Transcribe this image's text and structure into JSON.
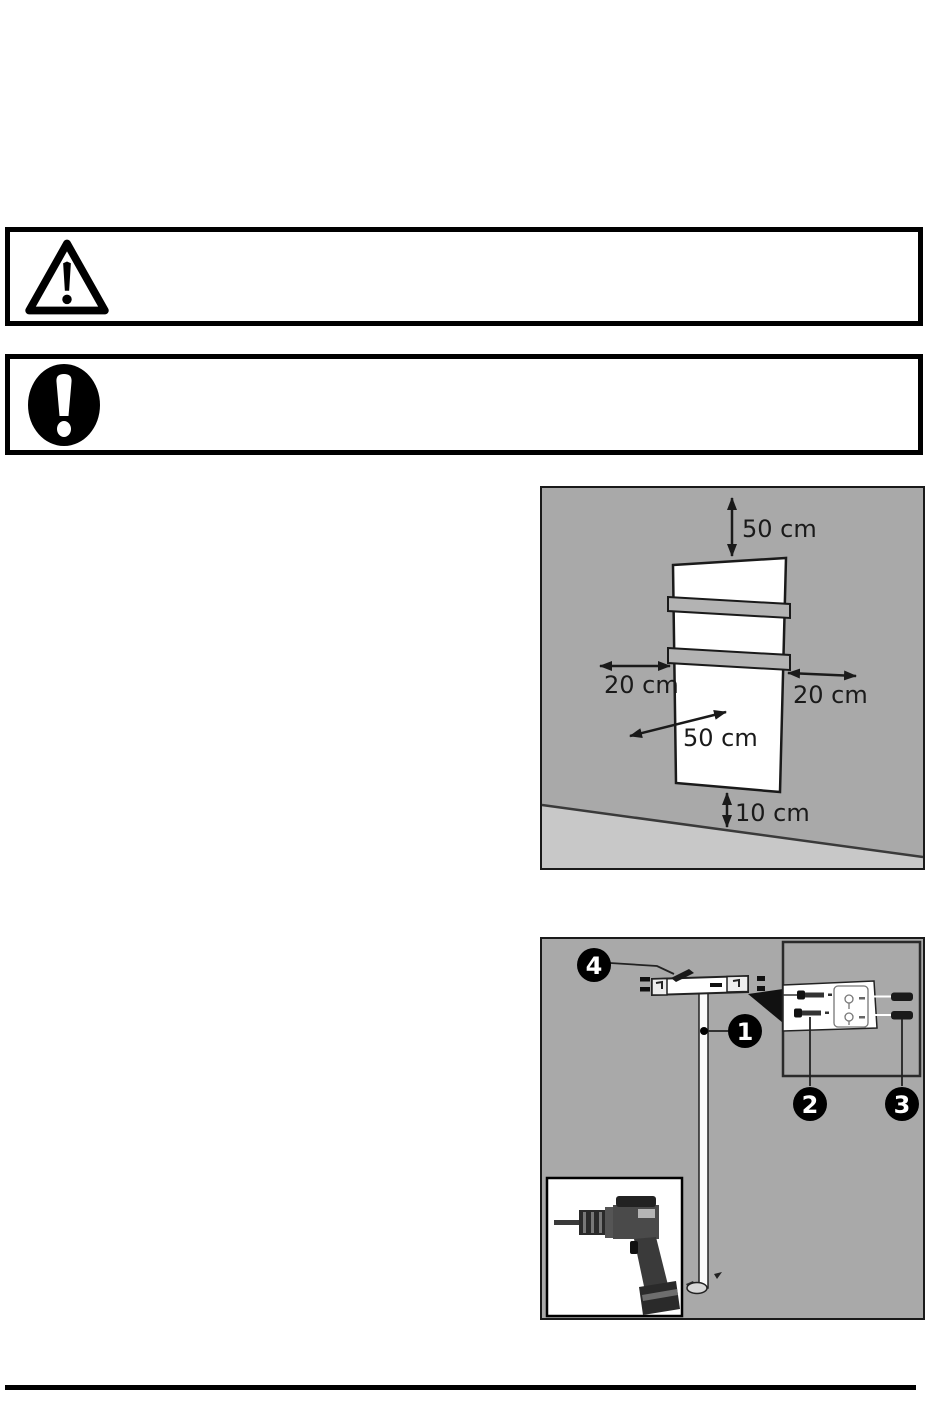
{
  "notices": [
    {
      "icon": "warning-triangle-icon",
      "text": ""
    },
    {
      "icon": "mandatory-exclamation-icon",
      "text": ""
    }
  ],
  "clearance_diagram": {
    "description": "wall-mounted panel minimum clearance distances",
    "labels": {
      "top": "50 cm",
      "left": "20 cm",
      "right": "20 cm",
      "front": "50 cm",
      "bottom": "10 cm"
    },
    "colors": {
      "wall": "#a9a9a9",
      "floor": "#c8c8c8",
      "panel": "#ffffff",
      "towel_bar": "#b3b3b3",
      "line": "#1a1a1a"
    }
  },
  "mounting_diagram": {
    "description": "wall bracket mounting with level, screws, anchors and drill",
    "callouts": [
      {
        "number": "1",
        "target": "support-rod"
      },
      {
        "number": "2",
        "target": "mounting-screw"
      },
      {
        "number": "3",
        "target": "wall-anchor"
      },
      {
        "number": "4",
        "target": "bracket-screw"
      }
    ],
    "insets": [
      "bracket-closeup",
      "drill"
    ],
    "colors": {
      "background": "#a9a9a9",
      "callout_bg": "#000000",
      "callout_text": "#ffffff"
    }
  }
}
